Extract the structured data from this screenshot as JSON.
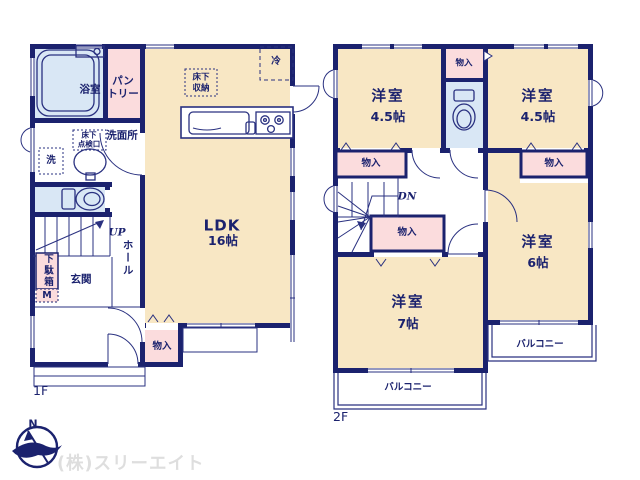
{
  "colors": {
    "wall": "#1b226e",
    "room_cream": "#f8e7c4",
    "closet_pink": "#fbdcdd",
    "wet_blue": "#d9e7f5",
    "company_gray": "#dedede"
  },
  "floor1": {
    "floor_label": "1F",
    "bath": "浴室",
    "pantry": "パン\nトリー",
    "fridge": "冷",
    "underfloor_storage": "床下\n収納",
    "washroom": "洗面所",
    "underfloor_hatch": "床下\n点検口",
    "washer": "洗",
    "stairs_up": "UP",
    "hall": "ホール",
    "shoe_cabinet": "下駄箱",
    "shoe_cabinet_m": "M",
    "entrance": "玄関",
    "ldk_name": "LDK",
    "ldk_size": "16帖",
    "closet": "物入"
  },
  "floor2": {
    "floor_label": "2F",
    "room_nw_name": "洋室",
    "room_nw_size": "4.5帖",
    "closet_top": "物入",
    "room_ne_name": "洋室",
    "room_ne_size": "4.5帖",
    "closet_west": "物入",
    "closet_east": "物入",
    "stairs_down": "DN",
    "closet_center": "物入",
    "room_sw_name": "洋室",
    "room_sw_size": "7帖",
    "room_se_name": "洋室",
    "room_se_size": "6帖",
    "balcony_east": "バルコニー",
    "balcony_south": "バルコニー"
  },
  "footer": {
    "compass_north": "N",
    "company": "(株)スリーエイト"
  }
}
